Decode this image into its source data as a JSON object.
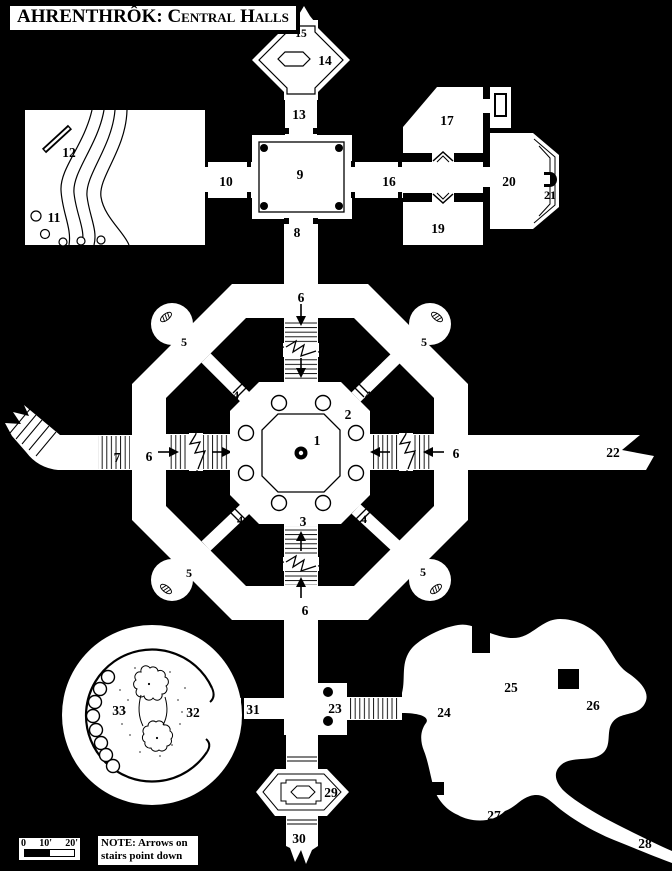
{
  "colors": {
    "background": "#000000",
    "floor": "#ffffff",
    "ink": "#000000"
  },
  "title": {
    "name_part": "AHRENTHRÔK:",
    "subtitle_part": "Central Halls"
  },
  "scale_bar": {
    "ticks": [
      "0",
      "10'",
      "20'"
    ]
  },
  "note": {
    "line1": "NOTE: Arrows on",
    "line2": "stairs point down"
  },
  "labels": {
    "n1": "1",
    "n2": "2",
    "n3": "3",
    "n4": "4",
    "n5": "5",
    "n6": "6",
    "n7": "7",
    "n8": "8",
    "n9": "9",
    "n10": "10",
    "n11": "11",
    "n12": "12",
    "n13": "13",
    "n14": "14",
    "n15": "15",
    "n16": "16",
    "n17": "17",
    "n19": "19",
    "n20": "20",
    "n21": "21",
    "n22": "22",
    "n23": "23",
    "n24": "24",
    "n25": "25",
    "n26": "26",
    "n27": "27",
    "n28": "28",
    "n29": "29",
    "n30": "30",
    "n31": "31",
    "n32": "32",
    "n33": "33"
  }
}
